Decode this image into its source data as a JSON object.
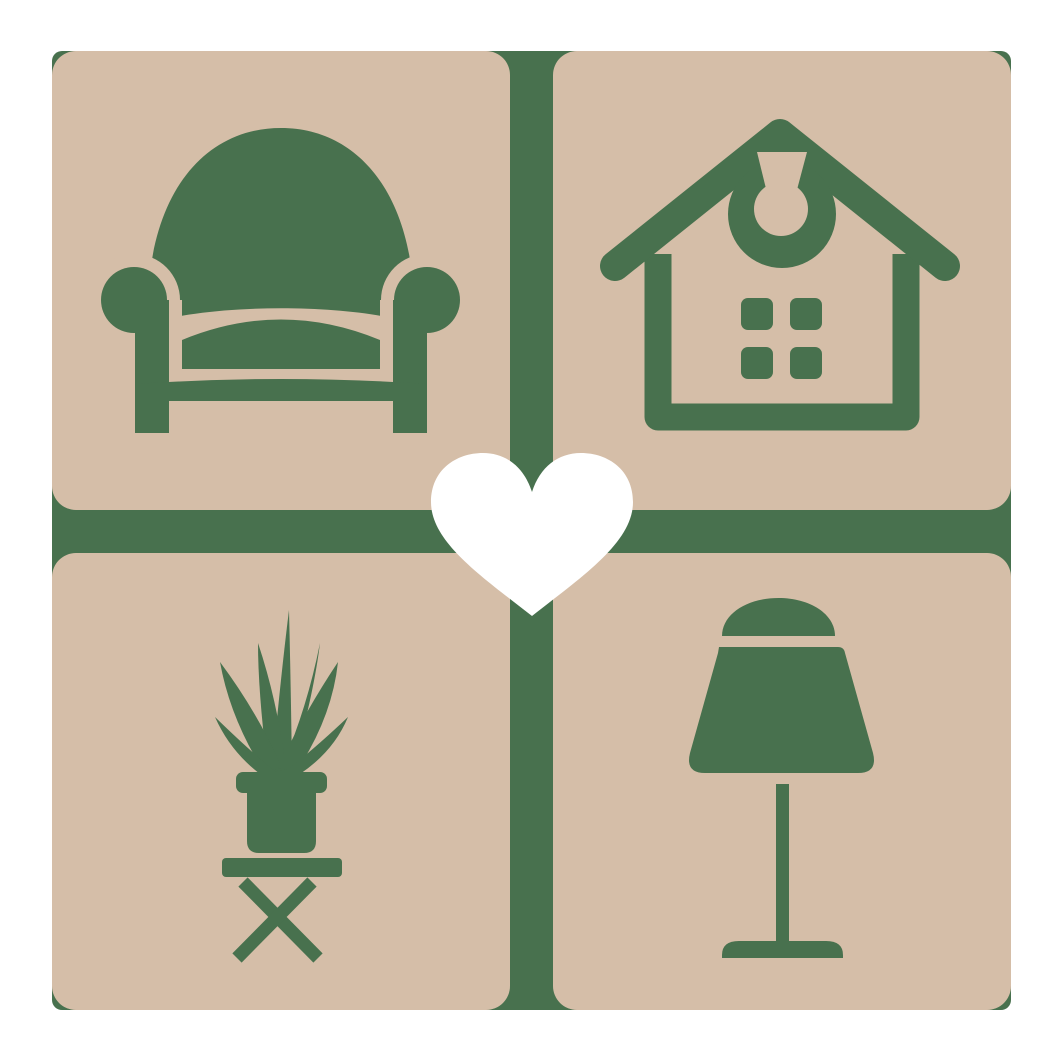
{
  "logo": {
    "name": "home-decor-heart-logo",
    "colors": {
      "icon_green": "#48714e",
      "tile_beige": "#d5bea8",
      "heart_white": "#ffffff",
      "page_background": "#ffffff"
    },
    "layout": {
      "grid": "2x2 rounded tiles over green rounded backing with cross-shaped gap",
      "center_overlay": "white heart"
    },
    "tiles": [
      {
        "position": "top-left",
        "icon": "armchair-icon"
      },
      {
        "position": "top-right",
        "icon": "house-icon"
      },
      {
        "position": "bottom-left",
        "icon": "potted-plant-icon"
      },
      {
        "position": "bottom-right",
        "icon": "table-lamp-icon"
      }
    ],
    "center": {
      "icon": "heart-icon"
    }
  }
}
